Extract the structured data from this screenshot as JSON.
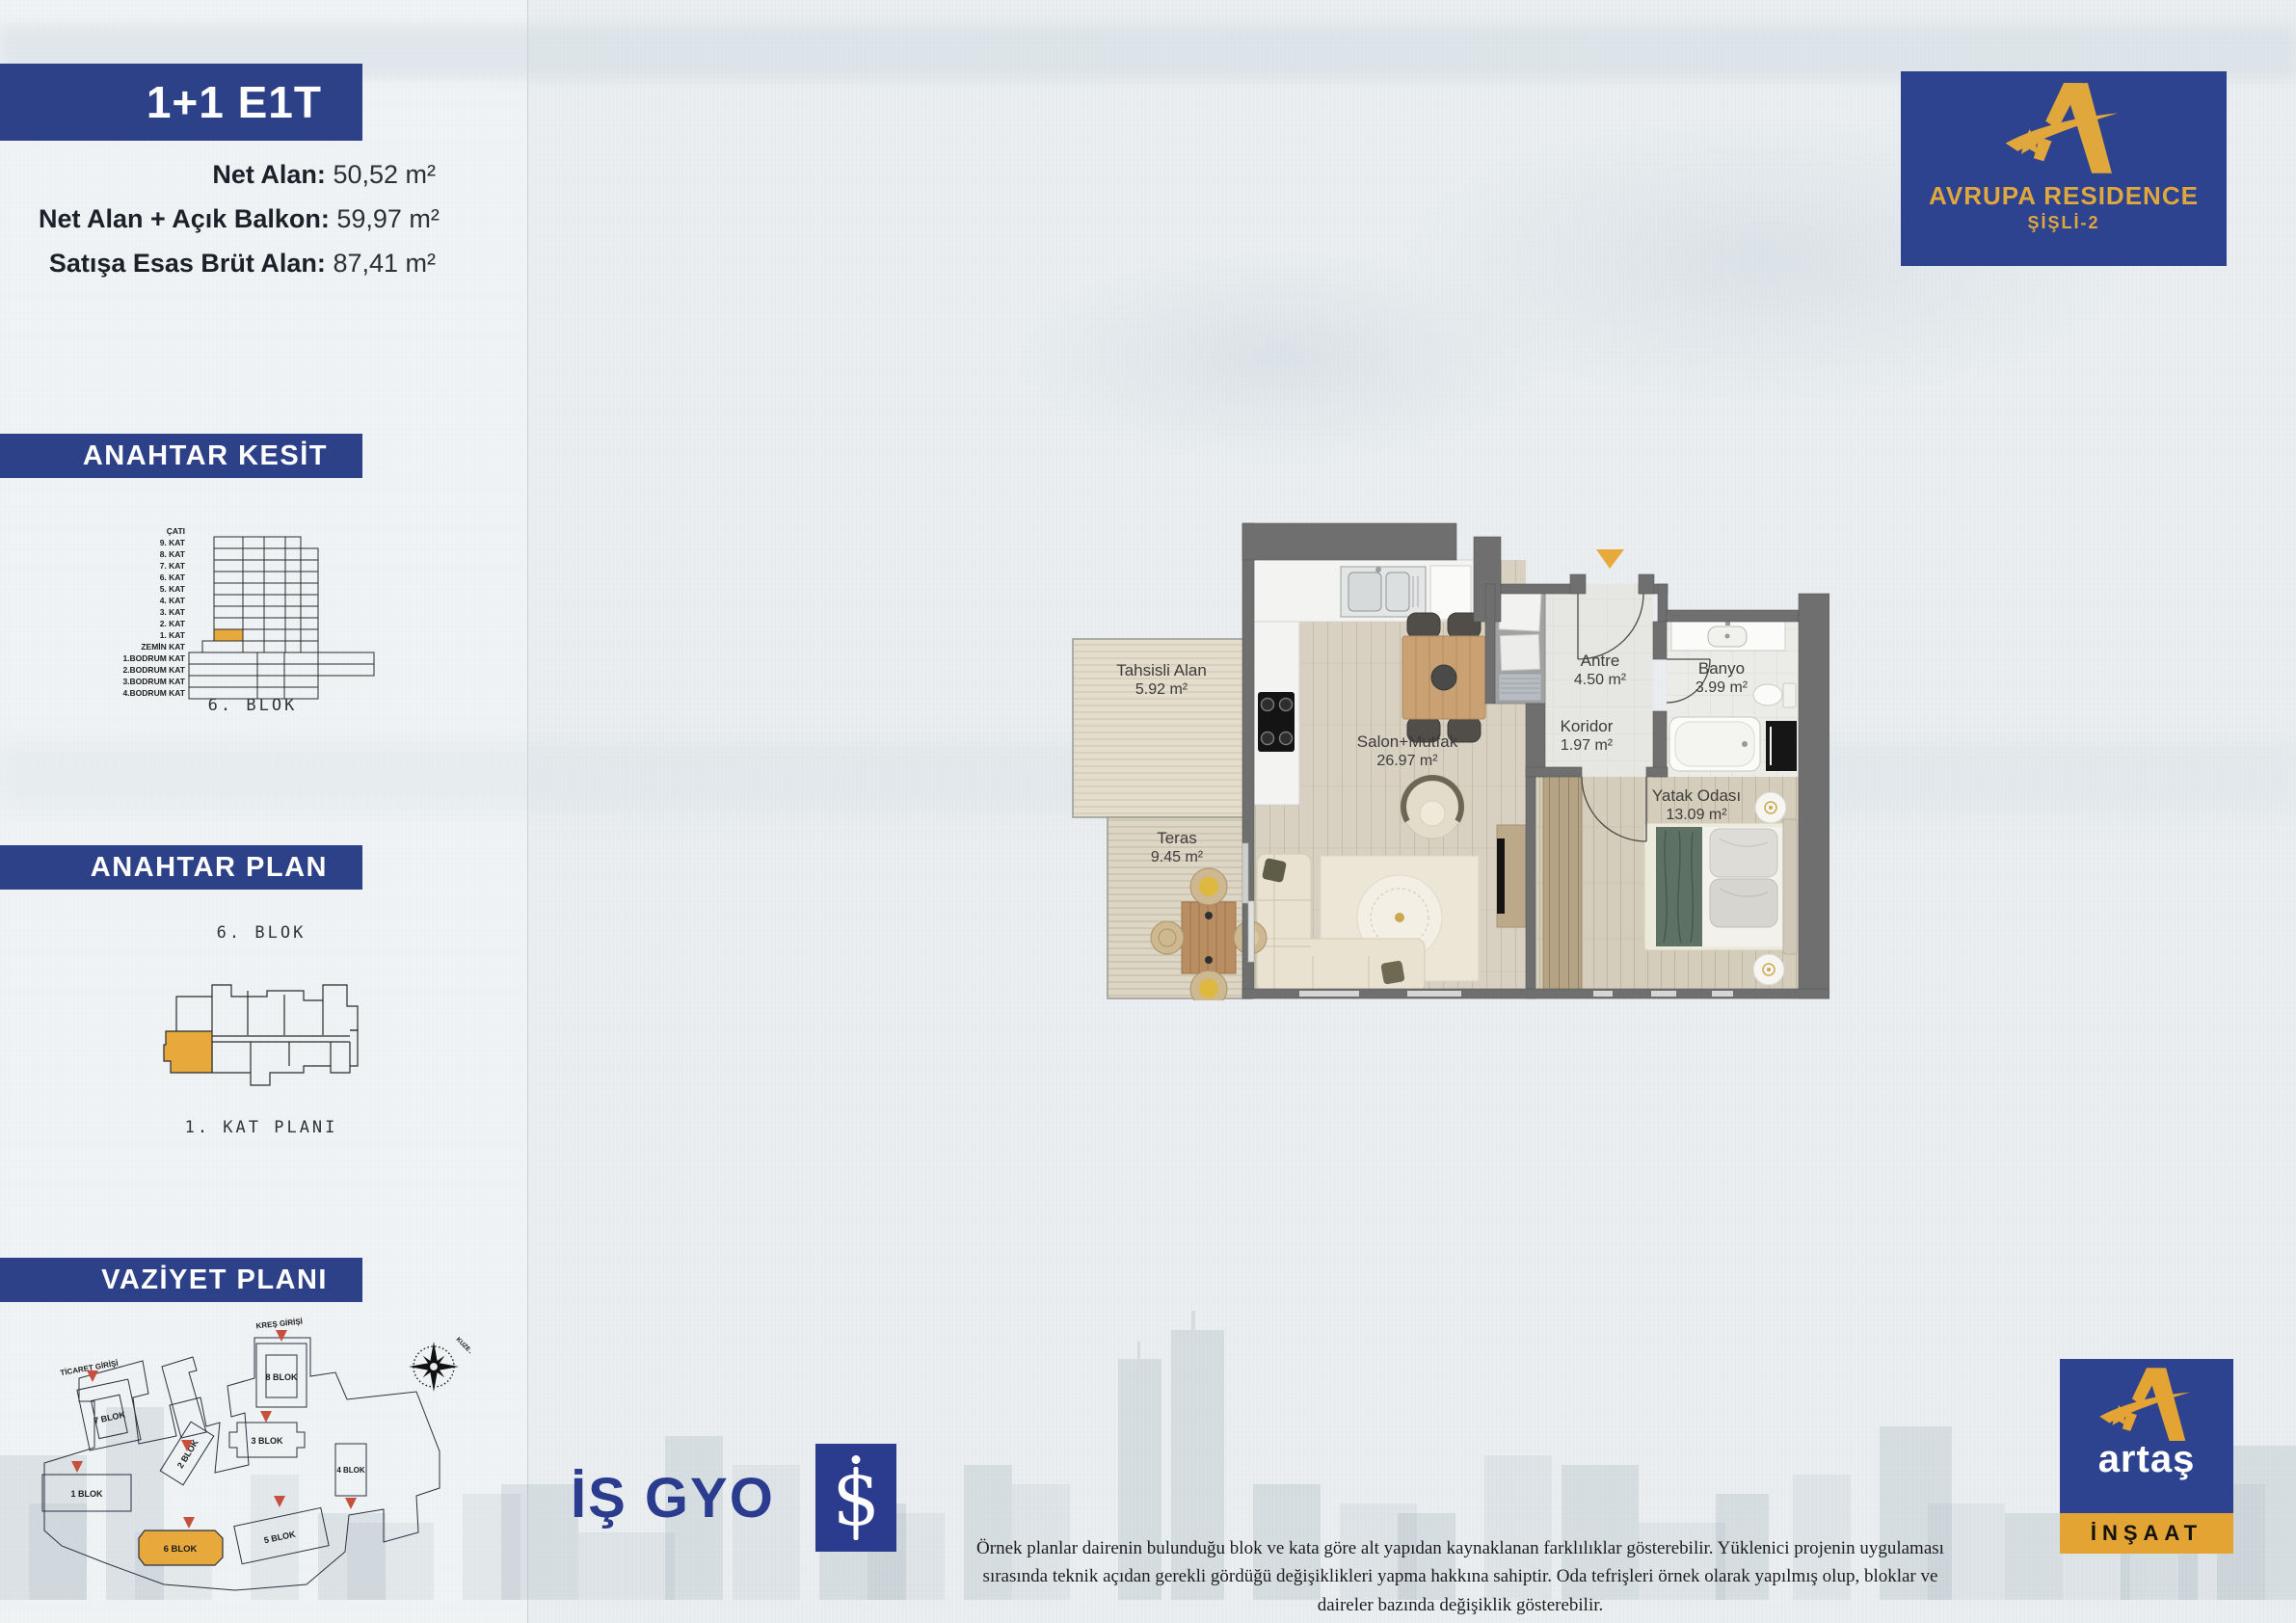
{
  "unit": {
    "code": "1+1 E1T",
    "specs": [
      {
        "label": "Net Alan:",
        "value": "50,52 m²"
      },
      {
        "label": "Net Alan + Açık Balkon:",
        "value": "59,97 m²"
      },
      {
        "label": "Satışa Esas Brüt Alan:",
        "value": "87,41 m²"
      }
    ]
  },
  "sections": {
    "kesit": {
      "title": "ANAHTAR KESİT",
      "caption": "6. BLOK",
      "highlighted_floor": "1. KAT",
      "floors": [
        "ÇATI",
        "9. KAT",
        "8. KAT",
        "7. KAT",
        "6. KAT",
        "5. KAT",
        "4. KAT",
        "3. KAT",
        "2. KAT",
        "1. KAT",
        "ZEMİN KAT",
        "1.BODRUM KAT",
        "2.BODRUM KAT",
        "3.BODRUM KAT",
        "4.BODRUM KAT"
      ]
    },
    "anahtar_plan": {
      "title": "ANAHTAR PLAN",
      "block_label": "6. BLOK",
      "caption": "1. KAT PLANI"
    },
    "vaziyet": {
      "title": "VAZİYET PLANI",
      "compass_label": "KUZEY",
      "highlighted_block": "6 BLOK",
      "entrances": [
        {
          "label": "TİCARET GİRİŞİ"
        },
        {
          "label": "KREŞ GİRİŞİ"
        }
      ],
      "blocks": [
        {
          "label": "1 BLOK"
        },
        {
          "label": "2 BLOK"
        },
        {
          "label": "3 BLOK"
        },
        {
          "label": "4 BLOK"
        },
        {
          "label": "5 BLOK"
        },
        {
          "label": "6 BLOK"
        },
        {
          "label": "7 BLOK"
        },
        {
          "label": "8 BLOK"
        }
      ]
    }
  },
  "floorplan": {
    "rooms": [
      {
        "name": "Tahsisli Alan",
        "area": "5.92 m²"
      },
      {
        "name": "Teras",
        "area": "9.45 m²"
      },
      {
        "name": "Salon+Mutfak",
        "area": "26.97 m²"
      },
      {
        "name": "Antre",
        "area": "4.50 m²"
      },
      {
        "name": "Koridor",
        "area": "1.97 m²"
      },
      {
        "name": "Banyo",
        "area": "3.99 m²"
      },
      {
        "name": "Yatak Odası",
        "area": "13.09 m²"
      }
    ]
  },
  "branding": {
    "residence": {
      "name": "AVRUPA RESIDENCE",
      "location": "ŞİŞLİ-2"
    },
    "isgyo": {
      "name": "İŞ GYO",
      "symbol": "S"
    },
    "artas": {
      "name": "artaş",
      "division": "İNŞAAT"
    }
  },
  "footer": {
    "disclaimer": "Örnek planlar dairenin bulunduğu blok ve kata göre alt yapıdan kaynaklanan farklılıklar gösterebilir. Yüklenici projenin uygulaması sırasında teknik açıdan gerekli gördüğü değişiklikleri yapma hakkına sahiptir. Oda tefrişleri örnek olarak yapılmış olup, bloklar ve daireler bazında değişiklik gösterebilir."
  },
  "colors": {
    "navy": "#2d4189",
    "gold": "#e8a93c",
    "wall_gray": "#6f6f6f",
    "marker_red": "#c6503c"
  }
}
